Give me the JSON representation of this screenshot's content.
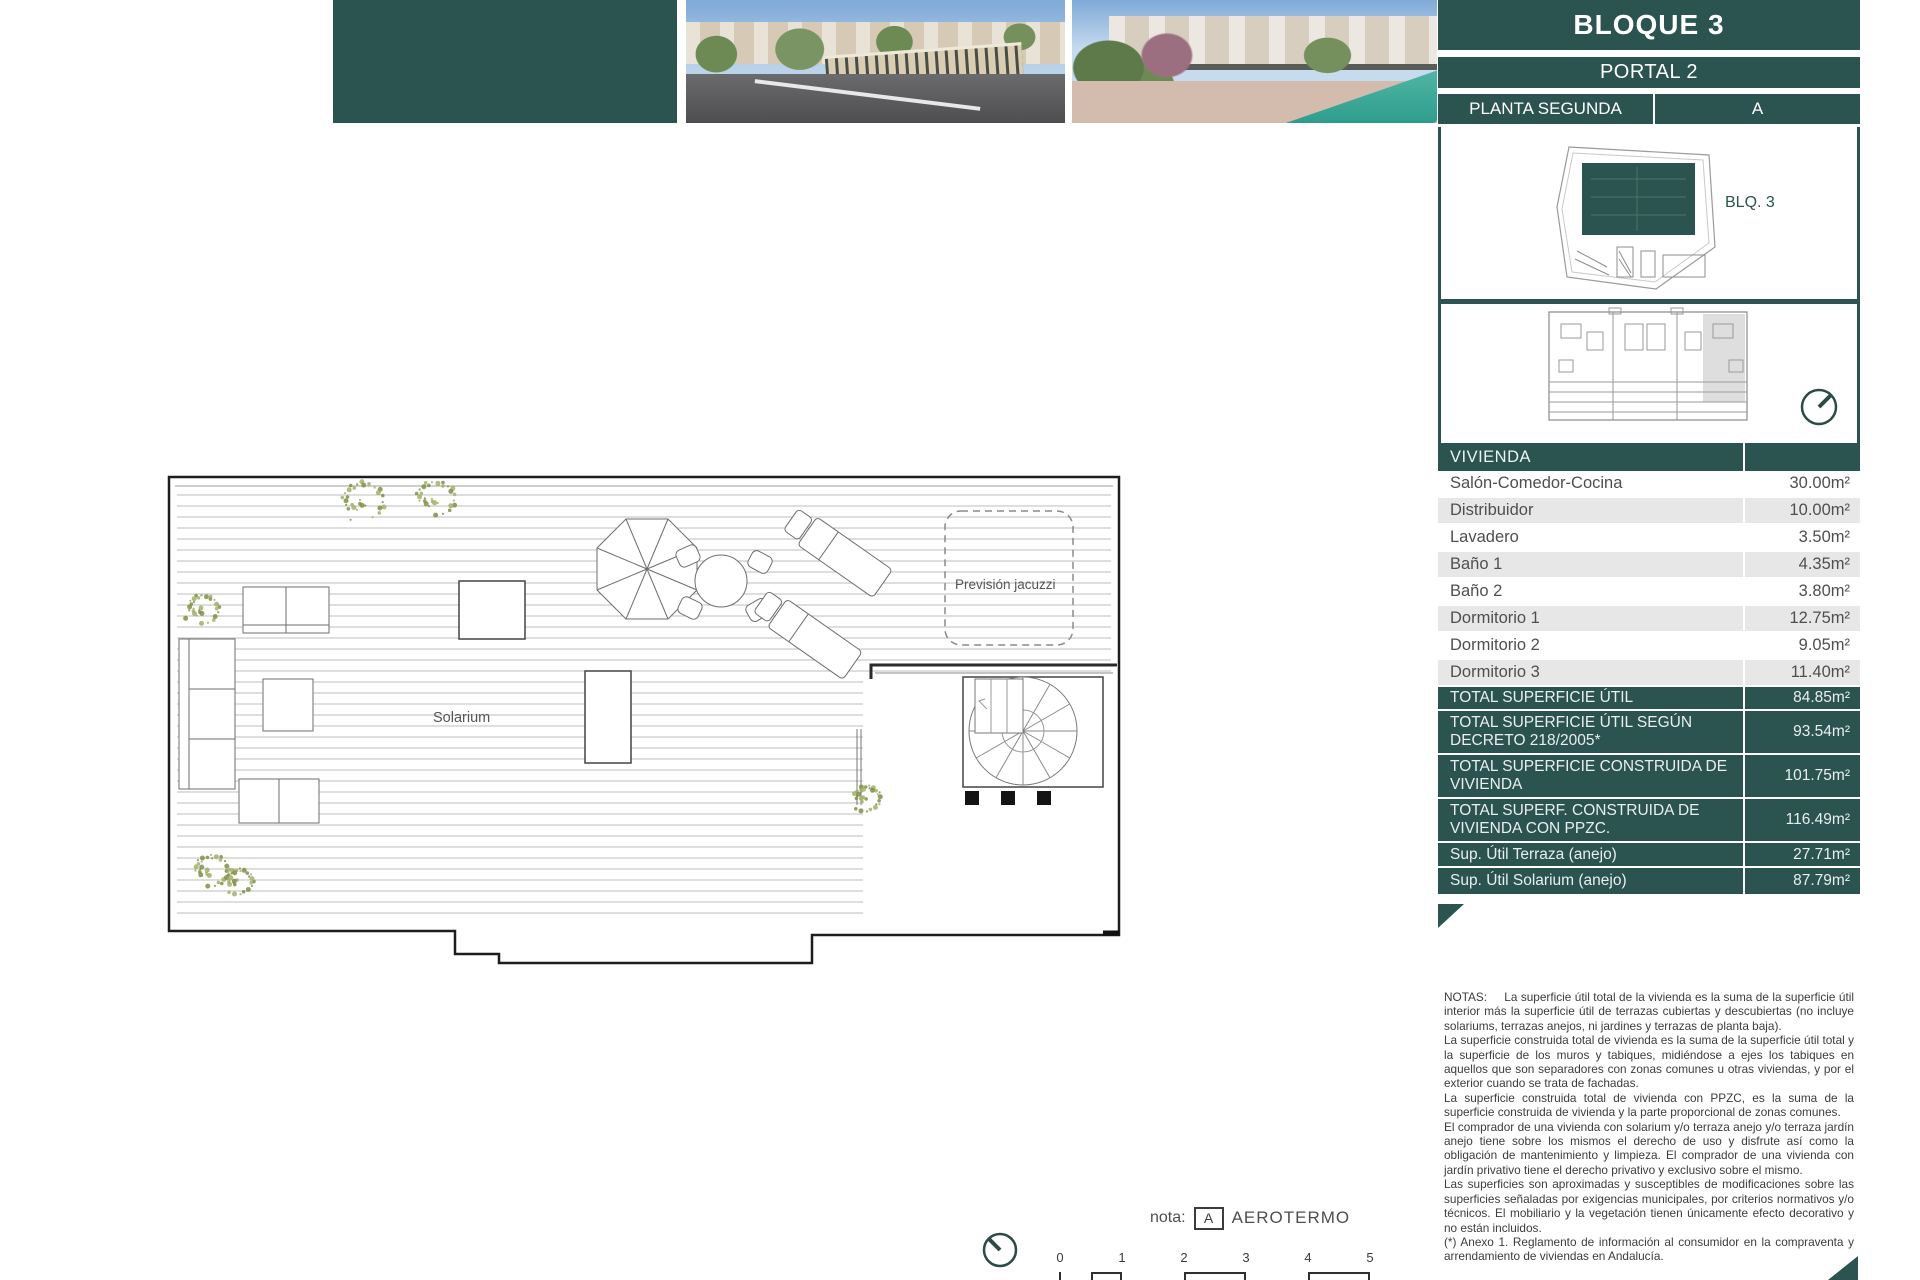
{
  "header": {
    "bloque": "BLOQUE 3",
    "portal": "PORTAL 2",
    "planta": "PLANTA SEGUNDA",
    "unit": "A"
  },
  "site_plan": {
    "block_label": "BLQ. 3"
  },
  "floor_plan": {
    "solarium_label": "Solarium",
    "jacuzzi_label": "Previsión jacuzzi"
  },
  "area_table": {
    "header": "VIVIENDA",
    "rows": [
      {
        "label": "Salón-Comedor-Cocina",
        "value": "30.00m²"
      },
      {
        "label": "Distribuidor",
        "value": "10.00m²"
      },
      {
        "label": "Lavadero",
        "value": "3.50m²"
      },
      {
        "label": "Baño 1",
        "value": "4.35m²"
      },
      {
        "label": "Baño 2",
        "value": "3.80m²"
      },
      {
        "label": "Dormitorio 1",
        "value": "12.75m²"
      },
      {
        "label": "Dormitorio 2",
        "value": "9.05m²"
      },
      {
        "label": "Dormitorio 3",
        "value": "11.40m²"
      }
    ],
    "totals": [
      {
        "label": "TOTAL SUPERFICIE ÚTIL",
        "value": "84.85m²"
      },
      {
        "label": "TOTAL SUPERFICIE ÚTIL SEGÚN DECRETO 218/2005*",
        "value": "93.54m²"
      },
      {
        "label": "TOTAL SUPERFICIE CONSTRUIDA DE VIVIENDA",
        "value": "101.75m²"
      },
      {
        "label": "TOTAL SUPERF. CONSTRUIDA DE VIVIENDA CON PPZC.",
        "value": "116.49m²"
      },
      {
        "label": "Sup. Útil Terraza (anejo)",
        "value": "27.71m²"
      },
      {
        "label": "Sup. Útil Solarium (anejo)",
        "value": "87.79m²"
      }
    ]
  },
  "notes": {
    "label": "NOTAS:",
    "paragraphs": [
      "La superficie útil total de la vivienda es la suma de la superficie útil interior más la superficie útil de terrazas cubiertas y descubiertas (no incluye solariums, terrazas anejos, ni jardines y terrazas de planta baja).",
      "La superficie construida total de vivienda es la suma de la superficie útil total y la superficie de los muros y tabiques, midiéndose a ejes los tabiques en aquellos que son separadores con zonas comunes u otras viviendas, y por el exterior cuando se trata de fachadas.",
      "La superficie construida total de vivienda con PPZC, es la suma de la superficie construida de vivienda y la parte proporcional de zonas comunes.",
      "El comprador de una vivienda con solarium y/o terraza anejo y/o terraza jardín anejo tiene sobre los mismos el derecho de uso y disfrute así como la obligación de mantenimiento y limpieza. El comprador de una vivienda con jardín privativo tiene el derecho privativo y exclusivo sobre el mismo.",
      "Las superficies son aproximadas y susceptibles de modificaciones sobre las superficies señaladas por exigencias municipales, por criterios normativos y/o técnicos. El mobiliario y la vegetación tienen únicamente efecto decorativo y no están incluidos.",
      " (*) Anexo 1. Reglamento de información al consumidor en la compraventa y arrendamiento de viviendas en Andalucía."
    ]
  },
  "legend": {
    "nota_label": "nota:",
    "key": "A",
    "value": "AEROTERMO"
  },
  "scale_bar": {
    "ticks": [
      "0",
      "1",
      "2",
      "3",
      "4",
      "5"
    ]
  },
  "colors": {
    "teal": "#2b534f",
    "row_alt": "#e7e7e7",
    "plan_line": "#bdbdbd",
    "plant_green": "#8a9a50"
  }
}
